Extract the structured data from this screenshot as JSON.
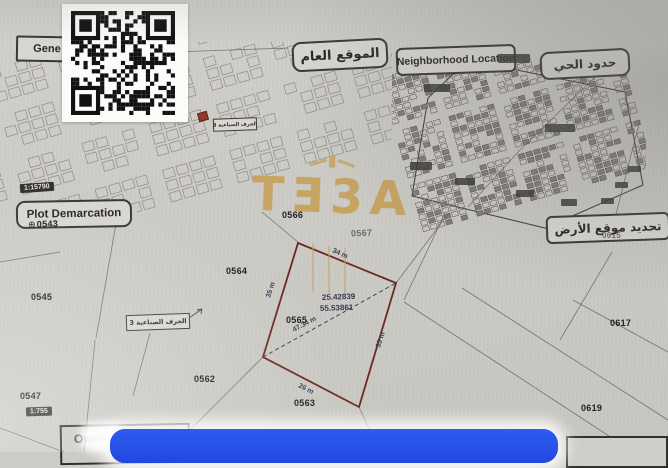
{
  "boxes": {
    "general_partial": "Gene",
    "general_ar": "الموقع العام",
    "neighborhood": "Neighborhood Location",
    "district_ar": "حدود الحي",
    "plot_demarcation": "Plot Demarcation",
    "site_ar": "تحديد موقع الأرض",
    "owner": "Owner Name"
  },
  "scales": {
    "general": "1:15790",
    "demarcation": "1:755"
  },
  "parcels": [
    {
      "num": "0543"
    },
    {
      "num": "0545"
    },
    {
      "num": "0547"
    },
    {
      "num": "0562"
    },
    {
      "num": "0563"
    },
    {
      "num": "0564"
    },
    {
      "num": "0565"
    },
    {
      "num": "0566"
    },
    {
      "num": "0567"
    },
    {
      "num": "0615"
    },
    {
      "num": "0617"
    },
    {
      "num": "0619"
    }
  ],
  "plot": {
    "number": "0565",
    "lat": "25.42839",
    "lng": "55.53861",
    "edge_top": "34 m",
    "edge_right": "35 m",
    "edge_bottom": "26 m",
    "edge_left": "35 m",
    "diagonal": "47.34 m",
    "border_color": "#6b2a1f"
  },
  "tags": {
    "jurf3": "الجرف الصناعية 3"
  },
  "symbols": {
    "benchmark": "⊕"
  },
  "watermark": {
    "text": "TƎ3A",
    "color": "#c6a058"
  },
  "colors": {
    "overlay_blue": "#2552ea",
    "paper": "#cdcbc6"
  }
}
